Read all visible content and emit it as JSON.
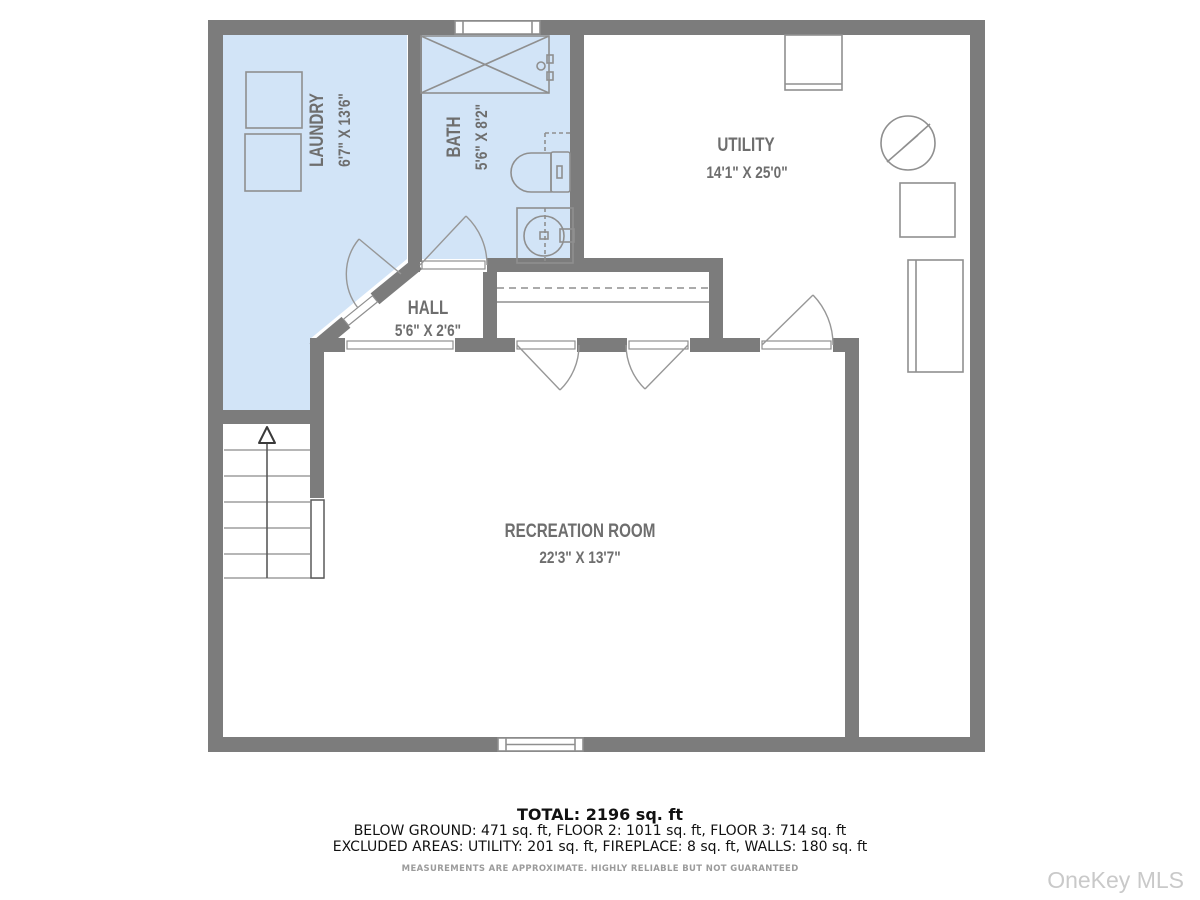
{
  "plan": {
    "rooms": [
      {
        "id": "laundry",
        "name": "LAUNDRY",
        "dims": "6'7\" X 13'6\""
      },
      {
        "id": "bath",
        "name": "BATH",
        "dims": "5'6\" X 8'2\""
      },
      {
        "id": "utility",
        "name": "UTILITY",
        "dims": "14'1\" X 25'0\""
      },
      {
        "id": "hall",
        "name": "HALL",
        "dims": "5'6\" X 2'6\""
      },
      {
        "id": "recreation",
        "name": "RECREATION ROOM",
        "dims": "22'3\" X 13'7\""
      }
    ],
    "fixtures": [
      "washer",
      "dryer",
      "shower",
      "toilet",
      "sink-vanity",
      "water-heater",
      "utility-equipment",
      "stairs-up"
    ],
    "colors": {
      "wall": "#7c7c7c",
      "room_fill": "#d2e4f7",
      "fixture_line": "#8f8f8f",
      "label": "#6e6e6e"
    }
  },
  "summary": {
    "total": "TOTAL: 2196 sq. ft",
    "floors": "BELOW GROUND: 471 sq. ft, FLOOR 2: 1011 sq. ft, FLOOR 3: 714 sq. ft",
    "excluded": "EXCLUDED AREAS: UTILITY: 201 sq. ft, FIREPLACE: 8 sq. ft, WALLS: 180 sq. ft",
    "disclaimer": "MEASUREMENTS ARE APPROXIMATE. HIGHLY RELIABLE BUT NOT GUARANTEED"
  },
  "watermark": "OneKey MLS"
}
